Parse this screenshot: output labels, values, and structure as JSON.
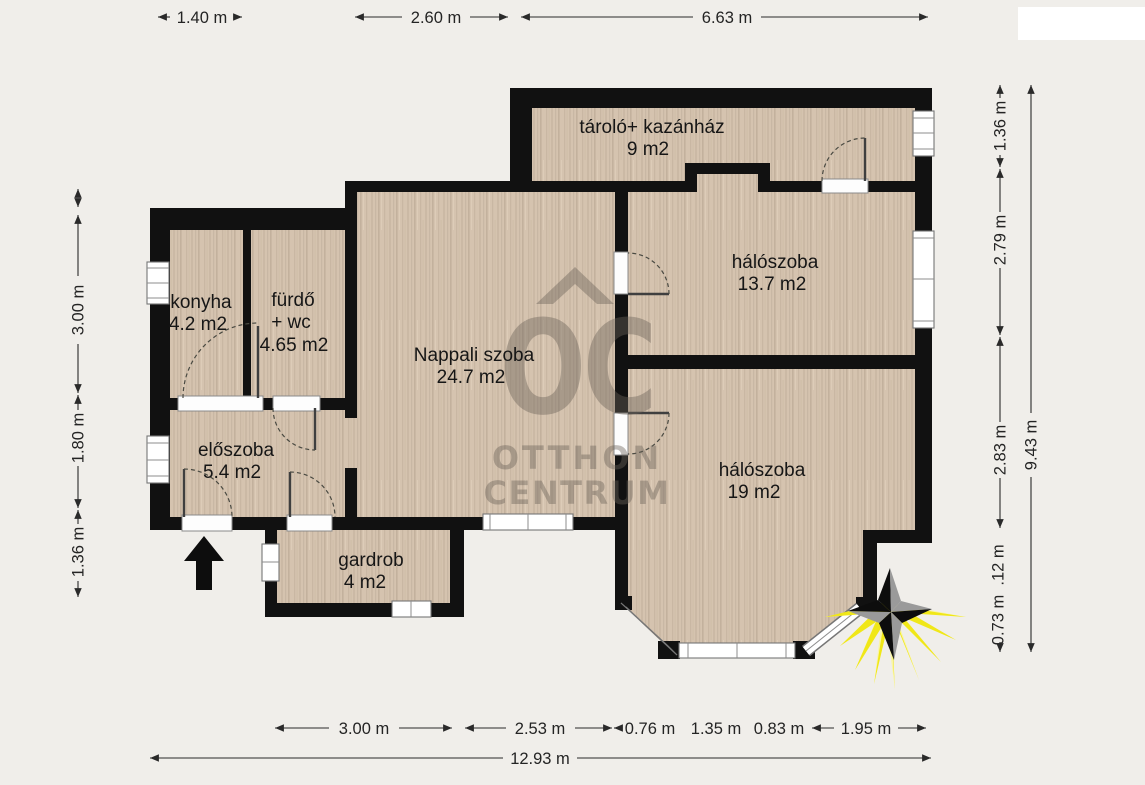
{
  "rooms": {
    "konyha": {
      "name": "konyha",
      "area": "4.2 m2"
    },
    "furdo": {
      "name": "fürdő",
      "name2": "+ wc",
      "area": "4.65 m2"
    },
    "eloszoba": {
      "name": "előszoba",
      "area": "5.4 m2"
    },
    "gardrob": {
      "name": "gardrob",
      "area": "4 m2"
    },
    "nappali": {
      "name": "Nappali szoba",
      "area": "24.7 m2"
    },
    "tarolo": {
      "name": "tároló+ kazánház",
      "area": "9 m2"
    },
    "haloszoba_kis": {
      "name": "hálószoba",
      "area": "13.7 m2"
    },
    "haloszoba_nagy": {
      "name": "hálószoba",
      "area": "19 m2"
    }
  },
  "dimensions": {
    "top": [
      "1.40 m",
      "2.60 m",
      "6.63 m"
    ],
    "bottom": [
      "3.00 m",
      "2.53 m",
      "0.76 m",
      "1.35 m",
      "0.83 m",
      "1.95 m"
    ],
    "bottom_total": "12.93 m",
    "left": [
      "3.00 m",
      "1.80 m",
      "1.36 m"
    ],
    "right": [
      "1.36 m",
      "2.79 m",
      "2.83 m",
      ".12 m",
      "0.73 m"
    ],
    "right_total": "9.43 m"
  },
  "watermark": {
    "logo": "OC",
    "line1": "OTTHON",
    "line2": "CENTRUM"
  },
  "colors": {
    "background": "#f0eeea",
    "wall": "#111111",
    "floor": "#d5c3af",
    "watermark": "#6b6259",
    "compass_yellow": "#f0e718",
    "compass_gray": "#9a9a9a"
  }
}
